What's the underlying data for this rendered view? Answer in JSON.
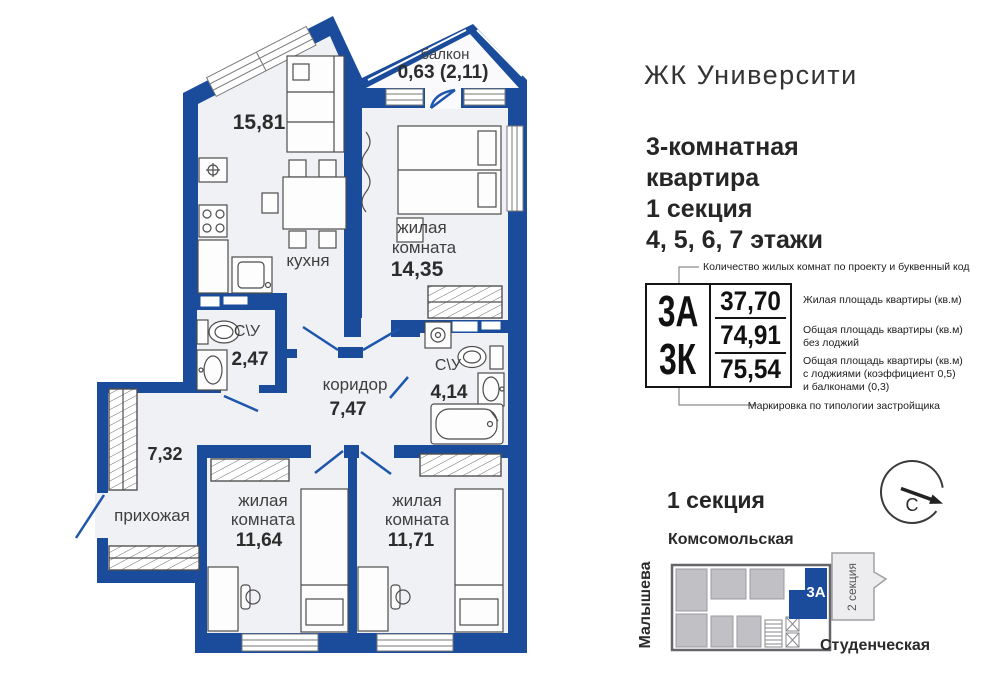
{
  "header": {
    "complex": "ЖК Университи",
    "apartment_l1": "3-комнатная",
    "apartment_l2": "квартира",
    "apartment_l3": "1 секция",
    "apartment_l4": "4, 5, 6, 7 этажи"
  },
  "plan": {
    "balcony": {
      "name": "балкон",
      "area": "0,63 (2,11)"
    },
    "kitchen": {
      "name": "кухня",
      "area": "15,81"
    },
    "bedroom1": {
      "name_l1": "жилая",
      "name_l2": "комната",
      "area": "14,35"
    },
    "bath1": {
      "name": "С\\У",
      "area": "2,47"
    },
    "corridor": {
      "name": "коридор",
      "area": "7,47"
    },
    "bath2": {
      "name": "С\\У",
      "area": "4,14"
    },
    "storage": {
      "area": "7,32"
    },
    "hall": {
      "name": "прихожая"
    },
    "bedroom2": {
      "name_l1": "жилая",
      "name_l2": "комната",
      "area": "11,64"
    },
    "bedroom3": {
      "name_l1": "жилая",
      "name_l2": "комната",
      "area": "11,71"
    }
  },
  "legend": {
    "top_note": "Количество жилых комнат по проекту и буквенный код",
    "code_top": "3А",
    "code_bottom": "3К",
    "rows": [
      {
        "value": "37,70",
        "l1": "Жилая площадь квартиры (кв.м)"
      },
      {
        "value": "74,91",
        "l1": "Общая площадь квартиры (кв.м)",
        "l2": "без лоджий"
      },
      {
        "value": "75,54",
        "l1": "Общая площадь квартиры (кв.м)",
        "l2": "с лоджиями (коэффициент 0,5)",
        "l3": "и балконами (0,3)"
      }
    ],
    "bottom_note": "Маркировка по типологии застройщика"
  },
  "minimap": {
    "title": "1 секция",
    "street_top": "Комсомольская",
    "street_left": "Малышева",
    "street_bottom": "Студенческая",
    "unit_label": "3А",
    "section2_label": "2 секция",
    "compass_north": "С"
  },
  "colors": {
    "wall_blue": "#1b4c9c",
    "floor": "#f0f1f4",
    "unit_highlight": "#1b4c9c",
    "map_gray": "#c1c1c5"
  }
}
